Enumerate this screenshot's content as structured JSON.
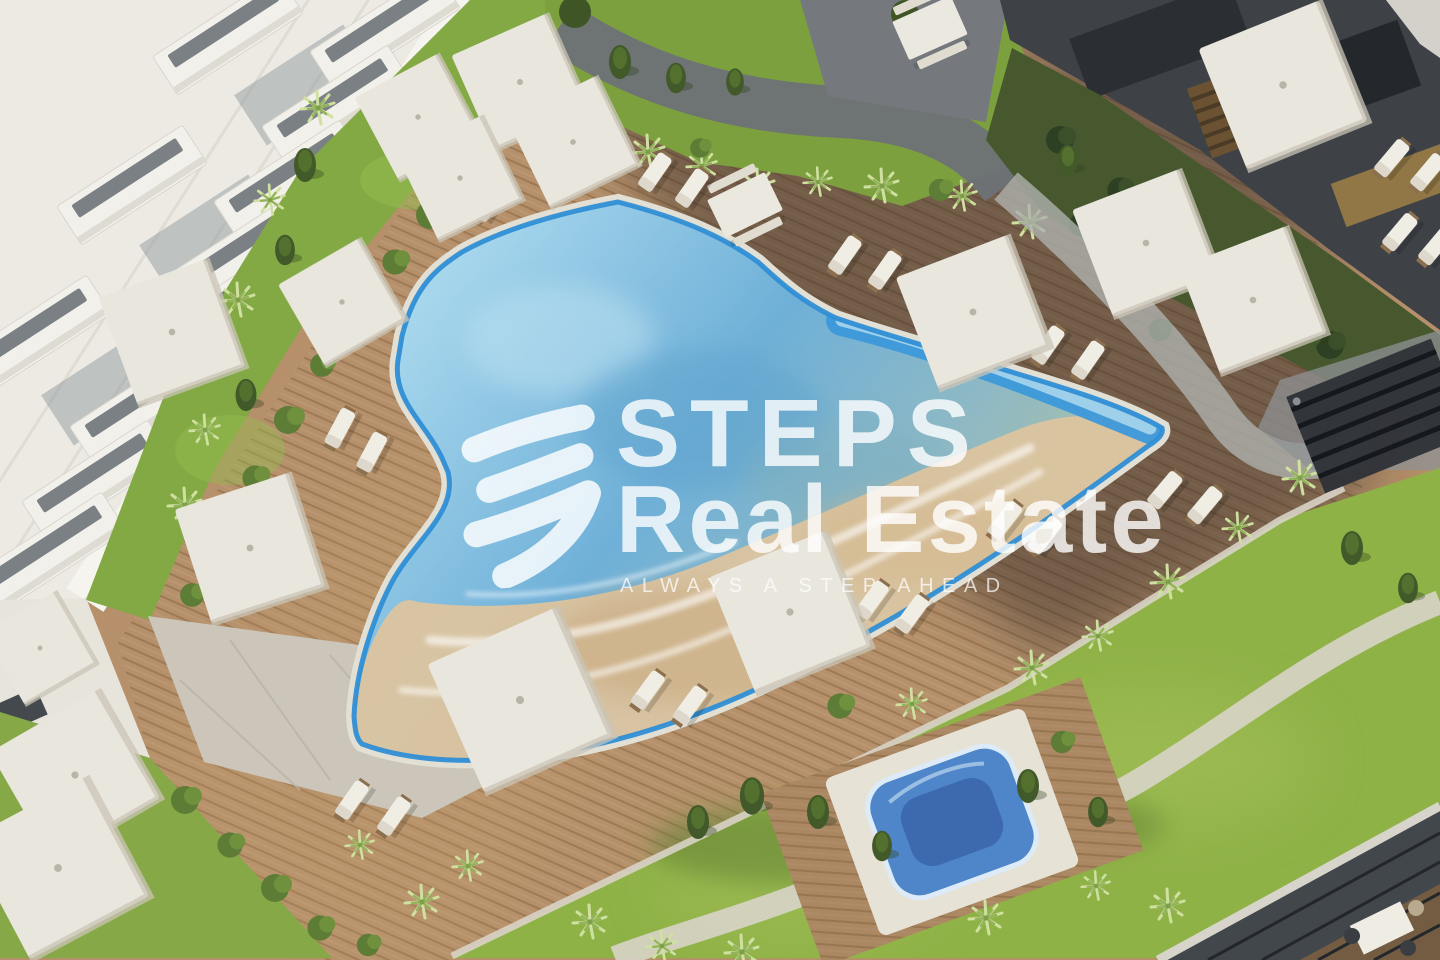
{
  "watermark": {
    "logo": "steps-zigzag-logo",
    "brand_line1": "STEPS",
    "brand_line2": "Real Estate",
    "tagline": "ALWAYS A STEP AHEAD"
  },
  "scene": {
    "type": "aerial-3d-architectural-render",
    "elements": [
      "white residential building with balconies",
      "free-form swimming pool with beach entry",
      "blue lap channel",
      "wooden sun deck",
      "white sun loungers",
      "square white parasols",
      "dining tables with benches",
      "square jacuzzi on wooden platform",
      "lawns with winding paths",
      "dark facade building",
      "shaded garden",
      "dark pergola",
      "glass corner lounge"
    ]
  },
  "colors": {
    "pool_rim": "#2f8ed5",
    "pool_water_light": "#a6d6ec",
    "pool_water_mid": "#6fb0d8",
    "pool_water_teal": "#8fb9c4",
    "lap_channel_blue": "#3d99da",
    "beach_sand": "#dcc49f",
    "deck_wood": "#b5906a",
    "deck_wood_stripe": "#9c7a55",
    "grass_bright": "#8fb247",
    "grass_mid": "#7da03f",
    "grass_shaded": "#47582f",
    "stone_light": "#cbc6b9",
    "path_dark": "#6d7276",
    "building_white": "#eceae3",
    "building_dark": "#3e4247",
    "jacuzzi_water": "#4f86c9",
    "watermark_white": "#ffffff"
  }
}
